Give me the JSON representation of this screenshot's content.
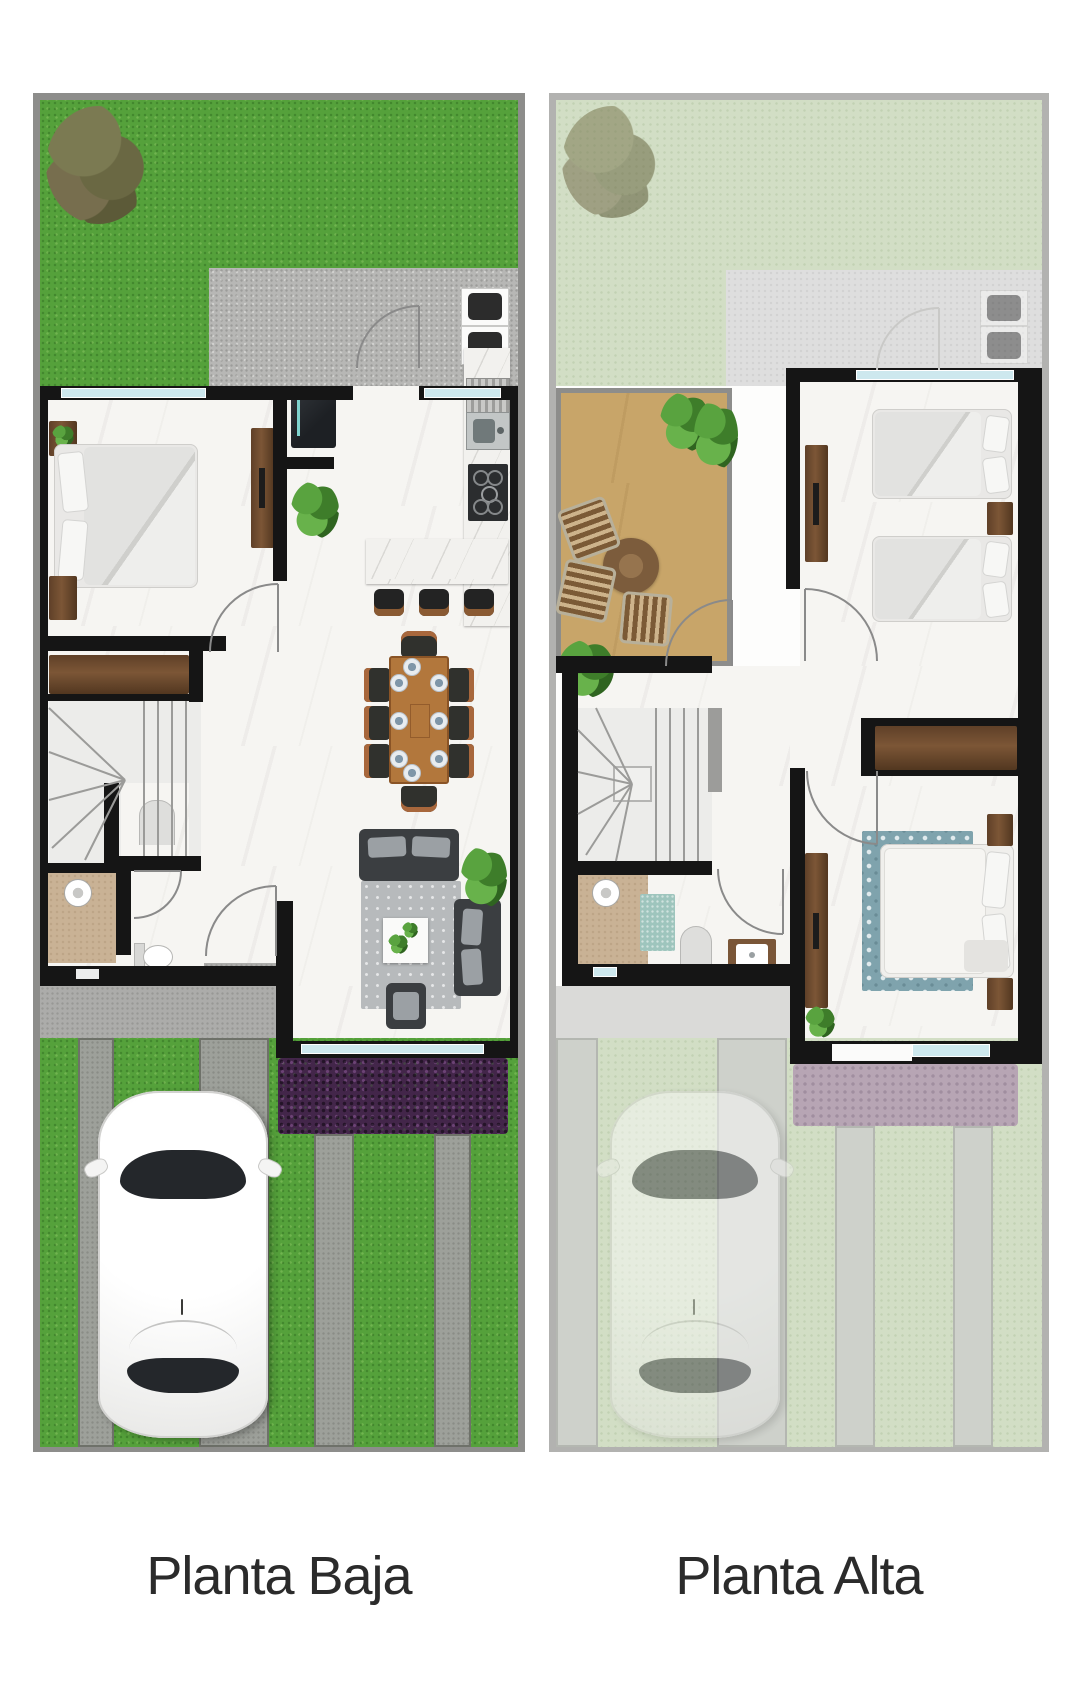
{
  "plans": [
    {
      "id": "planta-baja",
      "label": "Planta Baja"
    },
    {
      "id": "planta-alta",
      "label": "Planta Alta"
    }
  ],
  "colors": {
    "wall": "#151515",
    "grass": "#55a13b",
    "grass_faded": "#d2dec5",
    "patio": "#b7b7b5",
    "patio_faded": "#dedede",
    "concrete": "#9da09a",
    "concrete_faded": "#ced1cb",
    "sidewalk": "#acacaa",
    "window": "#cde8ee",
    "hedge": "#43264a",
    "hedge_faded": "#b7a5b4",
    "wood_dark": "#5d3e26",
    "wood_table": "#b2773c",
    "terrace_floor": "#c8a569",
    "bath_floor": "#c9b295",
    "sofa": "#3b3e41",
    "rug": "#b7babc",
    "rug_master": "#7fa3ad",
    "bath_mat": "#9ec5bd",
    "car_glass": "#24272b",
    "label_text": "#2b2b2b"
  }
}
